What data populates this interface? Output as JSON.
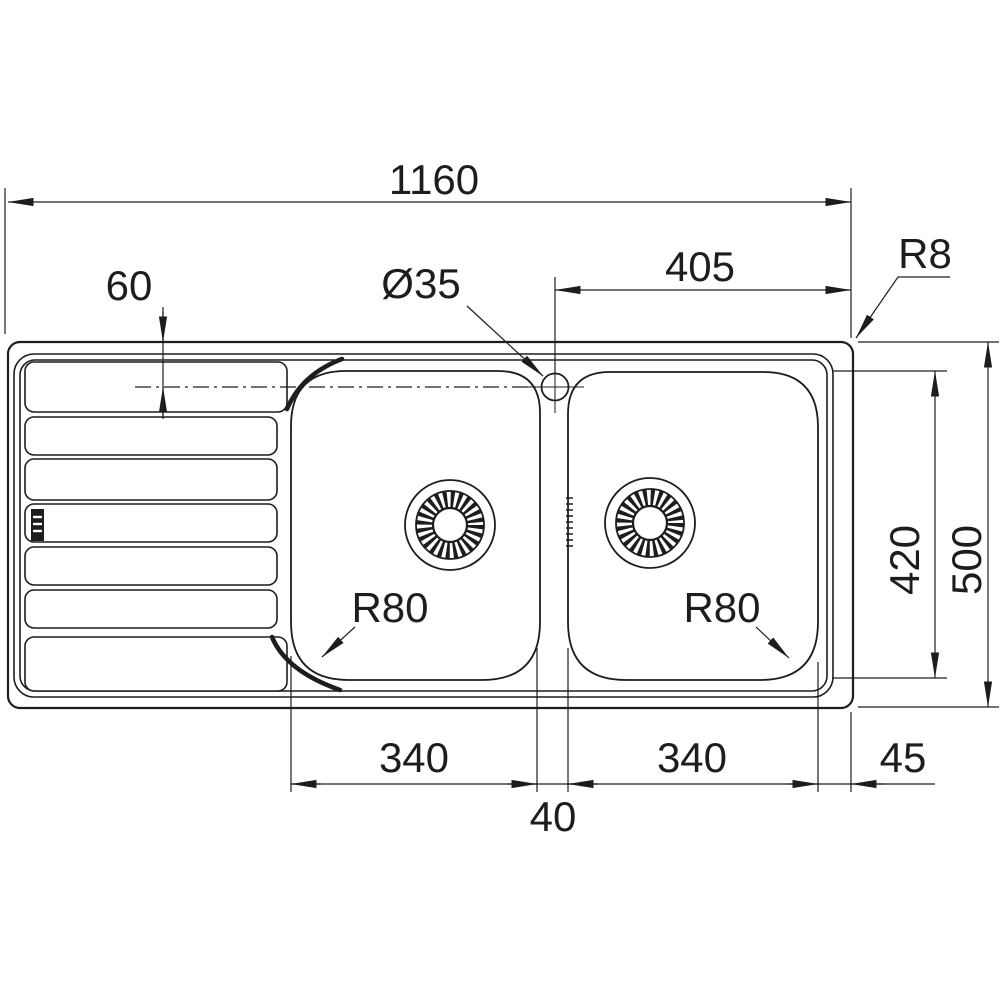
{
  "drawing": {
    "type": "technical-dimension-drawing",
    "subject": "double-bowl kitchen sink with left drainer, top view",
    "line_color": "#1d1d1b",
    "background_color": "#ffffff",
    "labels": {
      "overall_width": "1160",
      "tap_to_right_edge": "405",
      "rim_corner_radius": "R8",
      "edge_to_centerline": "60",
      "tap_hole_diameter": "Ø35",
      "bowl_length": "420",
      "overall_depth": "500",
      "left_bowl_corner_radius": "R80",
      "right_bowl_corner_radius": "R80",
      "left_bowl_width": "340",
      "right_bowl_width": "340",
      "bowl_gap": "40",
      "right_margin": "45"
    }
  }
}
